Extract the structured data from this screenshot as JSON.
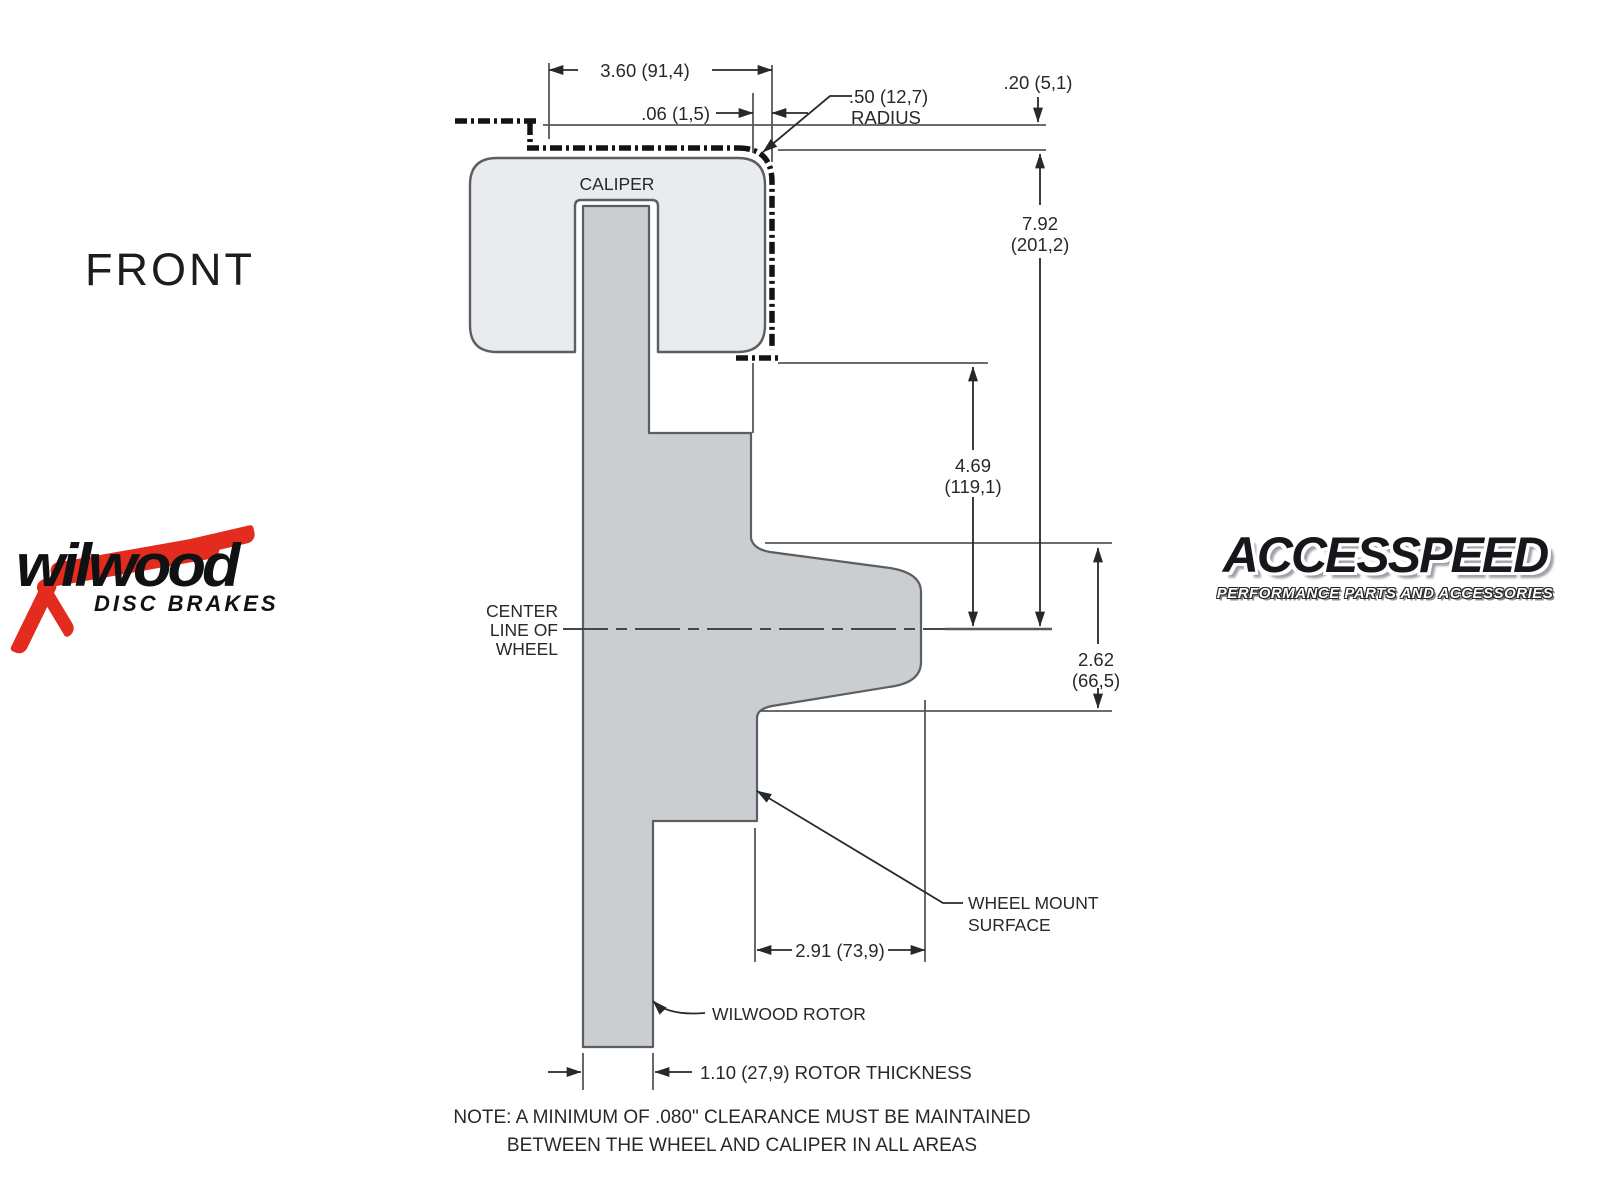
{
  "title": "FRONT",
  "caliper_label": "CALIPER",
  "centerline": {
    "l1": "CENTER",
    "l2": "LINE OF",
    "l3": "WHEEL"
  },
  "dims": {
    "width_top": "3.60 (91,4)",
    "clearance": ".06 (1,5)",
    "radius_val": ".50 (12,7)",
    "radius_word": "RADIUS",
    "lip": ".20 (5,1)",
    "total_in": "7.92",
    "total_mm": "(201,2)",
    "mid_in": "4.69",
    "mid_mm": "(119,1)",
    "mount_in": "2.62",
    "mount_mm": "(66,5)",
    "hat_depth": "2.91 (73,9)",
    "rotor_thickness": "1.10 (27,9) ROTOR THICKNESS"
  },
  "labels": {
    "wheel_mount_1": "WHEEL MOUNT",
    "wheel_mount_2": "SURFACE",
    "rotor": "WILWOOD ROTOR"
  },
  "note": {
    "line1": "NOTE: A MINIMUM OF .080\" CLEARANCE MUST BE MAINTAINED",
    "line2": "BETWEEN THE WHEEL AND CALIPER IN ALL AREAS"
  },
  "logos": {
    "wilwood": {
      "name": "wilwood",
      "tagline": "DISC BRAKES"
    },
    "accesspeed": {
      "name": "ACCESSPEED",
      "tagline": "PERFORMANCE PARTS AND ACCESSORIES"
    }
  },
  "colors": {
    "caliper": "#e9ebed",
    "rotor": "#cbced1",
    "outline": "#5b5f63",
    "line": "#55585c",
    "dim": "#26292c",
    "dash": "#131313",
    "red": "#e32b1e",
    "ink": "#101112",
    "bg": "#ffffff"
  }
}
